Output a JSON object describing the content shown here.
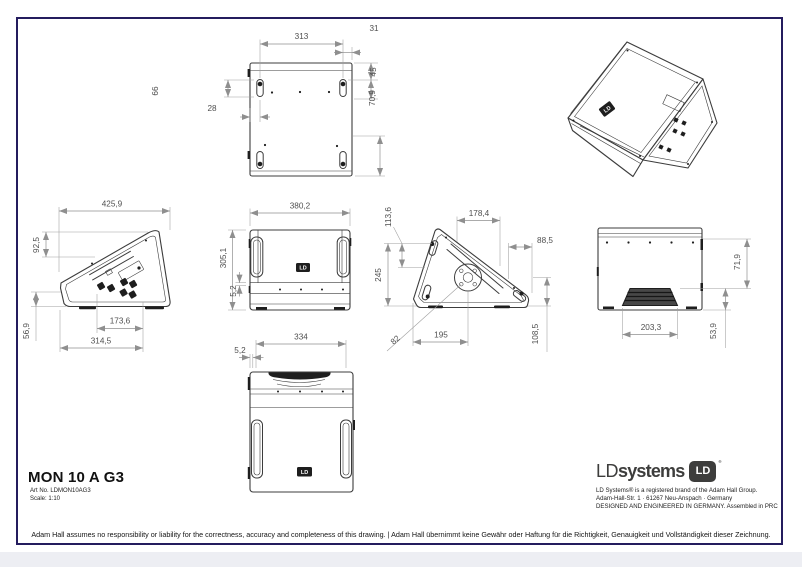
{
  "doc": {
    "footer_disclaimer": "Adam Hall assumes no responsibility or liability for the correctness, accuracy and completeness of this drawing.  |  Adam Hall übernimmt keine Gewähr oder Haftung für die Richtigkeit, Genauigkeit und Vollständigkeit dieser Zeichnung."
  },
  "title_block": {
    "title": "MON 10 A G3",
    "art_no": "Art No. LDMON10AG3",
    "scale": "Scale: 1:10"
  },
  "brand": {
    "wordmark_ld": "LD",
    "wordmark_systems": "systems",
    "badge_text": "LD",
    "reg_mark": "®",
    "tagline1": "LD Systems® is a registered brand of the Adam Hall Group.",
    "tagline2": "Adam-Hall-Str. 1 · 61267 Neu-Anspach · Germany",
    "tagline3": "DESIGNED AND ENGINEERED IN GERMANY. Assembled in PRC",
    "logo_color": "#3d3d3c",
    "border_color": "#241c5e"
  },
  "views": {
    "top": {
      "d_width": "313",
      "d_offset": "31",
      "d_slot_pitch": "66",
      "d_slot_inset": "28",
      "d_edge": "45",
      "d_depth": "70,9"
    },
    "side_left": {
      "d_overall": "425,9",
      "d_upper": "92,5",
      "d_lower": "56,9",
      "d_panel": "173,6",
      "d_base": "314,5"
    },
    "front": {
      "d_width": "380,2",
      "d_height": "305,1",
      "d_foot": "5,2"
    },
    "side_right": {
      "d_top": "178,4",
      "d_rear": "88,5",
      "d_drop": "113,6",
      "d_height": "245",
      "d_pole_x": "195",
      "d_pole_y": "108,5",
      "d_angle": "82"
    },
    "back": {
      "d_step_h": "71,9",
      "d_step_w": "203,3",
      "d_step_d": "53,9"
    },
    "bottom": {
      "d_width": "334",
      "d_lip": "5,2"
    }
  }
}
